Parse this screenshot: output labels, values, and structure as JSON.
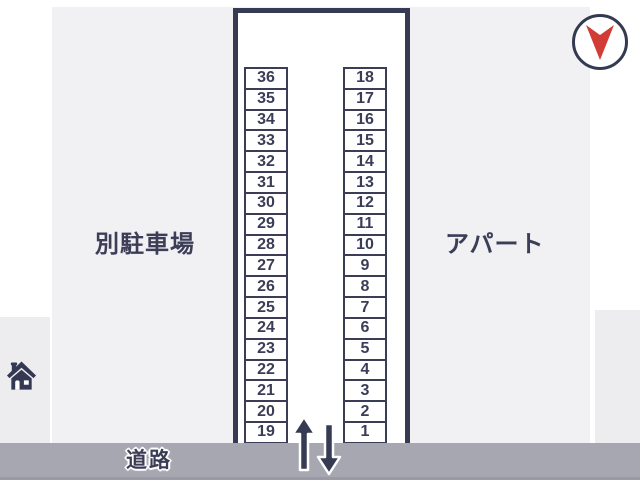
{
  "map": {
    "left_area_label": "別駐車場",
    "right_area_label": "アパート",
    "road_label": "道路"
  },
  "parking": {
    "left_column_stalls": [
      "36",
      "35",
      "34",
      "33",
      "32",
      "31",
      "30",
      "29",
      "28",
      "27",
      "26",
      "25",
      "24",
      "23",
      "22",
      "21",
      "20",
      "19"
    ],
    "right_column_stalls": [
      "18",
      "17",
      "16",
      "15",
      "14",
      "13",
      "12",
      "11",
      "10",
      "9",
      "8",
      "7",
      "6",
      "5",
      "4",
      "3",
      "2",
      "1"
    ]
  },
  "icons": {
    "compass": "compass-needle-icon (red, pointing down)",
    "home": "home-icon",
    "arrows": "entry-up-arrow and exit-down-arrow"
  },
  "colors": {
    "navy": "#363a52",
    "text_navy": "#3b3d56",
    "red": "#d23c37",
    "background": "#f1f1f4",
    "side_background": "#ededf0",
    "road": "#a7a7b1",
    "white": "#ffffff"
  }
}
